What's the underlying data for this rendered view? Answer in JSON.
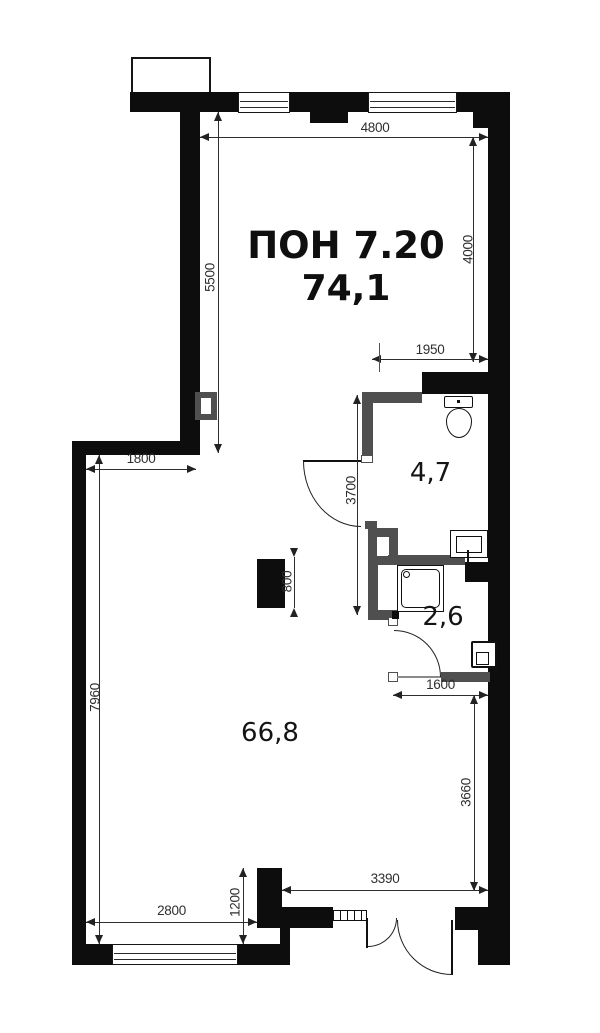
{
  "plan": {
    "title": "ПОН 7.20",
    "total_area": "74,1",
    "rooms": {
      "main": "66,8",
      "bathroom": "4,7",
      "shower": "2,6"
    },
    "dims": {
      "top_width": "4800",
      "upper_left_height": "5500",
      "upper_right_height": "4000",
      "bathroom_width": "1950",
      "bathroom_height": "3700",
      "ledge_width": "1800",
      "column_height": "800",
      "lower_left_height": "7960",
      "shower_width": "1600",
      "lower_right_height": "3660",
      "entry_width": "3390",
      "entry_step_height": "1200",
      "bottom_width": "2800"
    },
    "colors": {
      "wall": "#0d0d0d",
      "partition": "#4f4f4f",
      "dim_text": "#2f2f2f"
    }
  }
}
